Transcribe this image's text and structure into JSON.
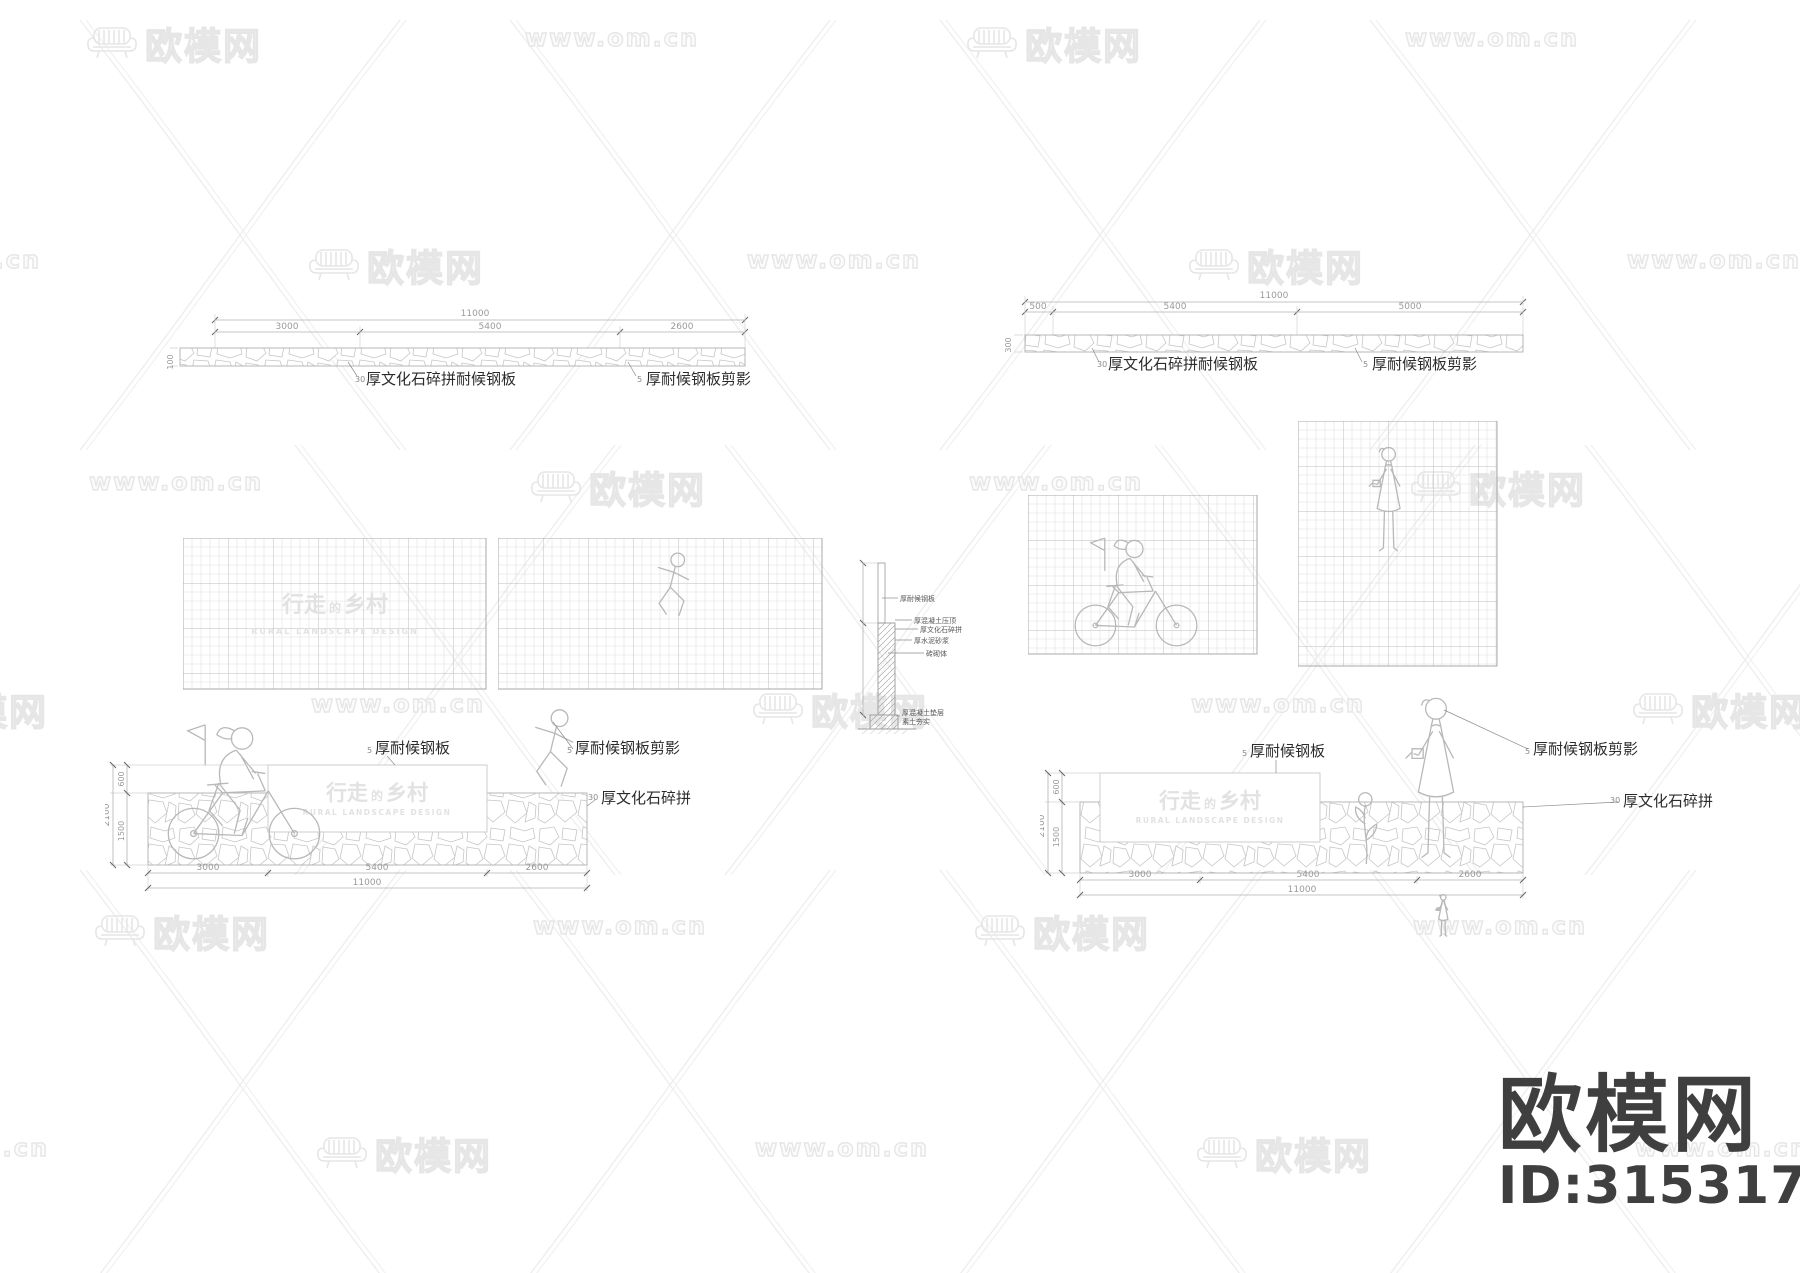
{
  "colors": {
    "line": "#b5b5b5",
    "dim_text": "#9a9a9a",
    "label_text": "#2b2b2b",
    "watermark": "#e7e7e7",
    "brand_dark": "#3f3f3f",
    "faint_text": "#e2e2e2"
  },
  "watermarks": {
    "brand": "欧模网",
    "site": "www.om.cn"
  },
  "brand_footer": {
    "name": "欧模网",
    "id": "ID:3153174"
  },
  "sign": {
    "t1": "行走",
    "t2": "的",
    "t3": "乡村",
    "subtitle": "RURAL LANDSCAPE DESIGN"
  },
  "labels": {
    "stone_steel_prefix": "30",
    "stone_steel": "厚文化石碎拼耐候钢板",
    "silhouette_prefix": "5",
    "silhouette": "厚耐候钢板剪影",
    "steel_prefix": "5",
    "steel": "厚耐候钢板",
    "stone_prefix": "30",
    "stone": "厚文化石碎拼"
  },
  "section_detail": {
    "l1": "厚耐候钢板",
    "l2": "厚混凝土压顶",
    "l3": "厚文化石碎拼",
    "l4": "厚水泥砂浆",
    "l5": "砖砌体",
    "l6": "厚混凝土垫层",
    "l7": "素土夯实"
  },
  "plan_left": {
    "total": "11000",
    "seg1": "3000",
    "seg2": "5400",
    "seg3": "2600",
    "thickness": "100"
  },
  "plan_right": {
    "total": "11000",
    "seg1": "500",
    "seg2": "5400",
    "seg3": "5000",
    "thickness": "300"
  },
  "elev_left": {
    "h_total": "11000",
    "h1": "3000",
    "h2": "5400",
    "h3": "2600",
    "v_total": "2100",
    "v1": "600",
    "v2": "1500"
  },
  "elev_right": {
    "h_total": "11000",
    "h1": "3000",
    "h2": "5400",
    "h3": "2600",
    "v_total": "2100",
    "v1": "600",
    "v2": "1500"
  }
}
